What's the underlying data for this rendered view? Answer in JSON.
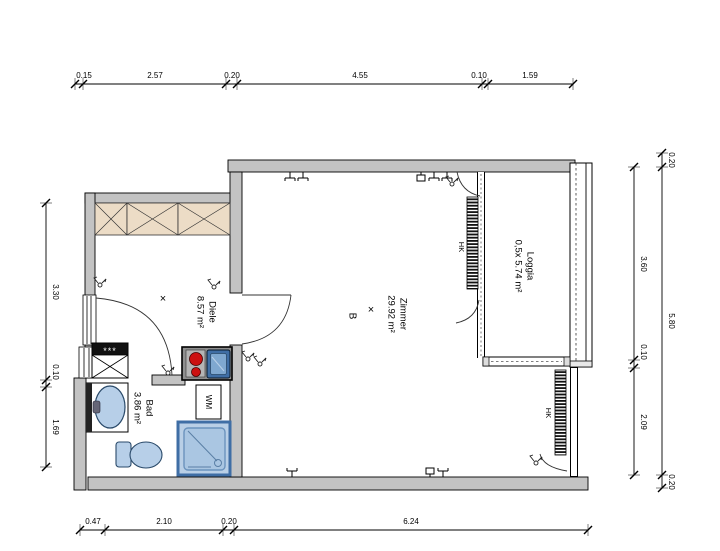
{
  "drawing_type": "floor-plan",
  "rooms": {
    "diele": {
      "name": "Diele",
      "area": "8.57 m²"
    },
    "bad": {
      "name": "Bad",
      "area": "3.86 m²"
    },
    "zimmer": {
      "name": "Zimmer",
      "area": "29.92 m²"
    },
    "loggia": {
      "name": "Loggia",
      "area": "0,5x 5.74 m²"
    }
  },
  "annotations": {
    "wm": "WM",
    "hk_top": "HK",
    "hk_bottom": "HK",
    "section_b": "B",
    "shaft_stars": "***",
    "cross": "×"
  },
  "dimensions": {
    "top": [
      "0.15",
      "2.57",
      "0.20",
      "4.55",
      "0.10",
      "1.59"
    ],
    "bottom": [
      "0.47",
      "2.10",
      "0.20",
      "6.24"
    ],
    "left": [
      "3.30",
      "0.10",
      "1.69"
    ],
    "right_inner": [
      "3.60",
      "0.10",
      "2.09"
    ],
    "right_outer": [
      "0.20",
      "5.80",
      "0.20"
    ]
  },
  "colors": {
    "wall": "#c3c3c3",
    "wardrobe": "#ecdcc6",
    "fixture": "#b7cfe8",
    "fixture_dark": "#4d7fb5",
    "burner": "#cc1111",
    "line": "#000000"
  }
}
